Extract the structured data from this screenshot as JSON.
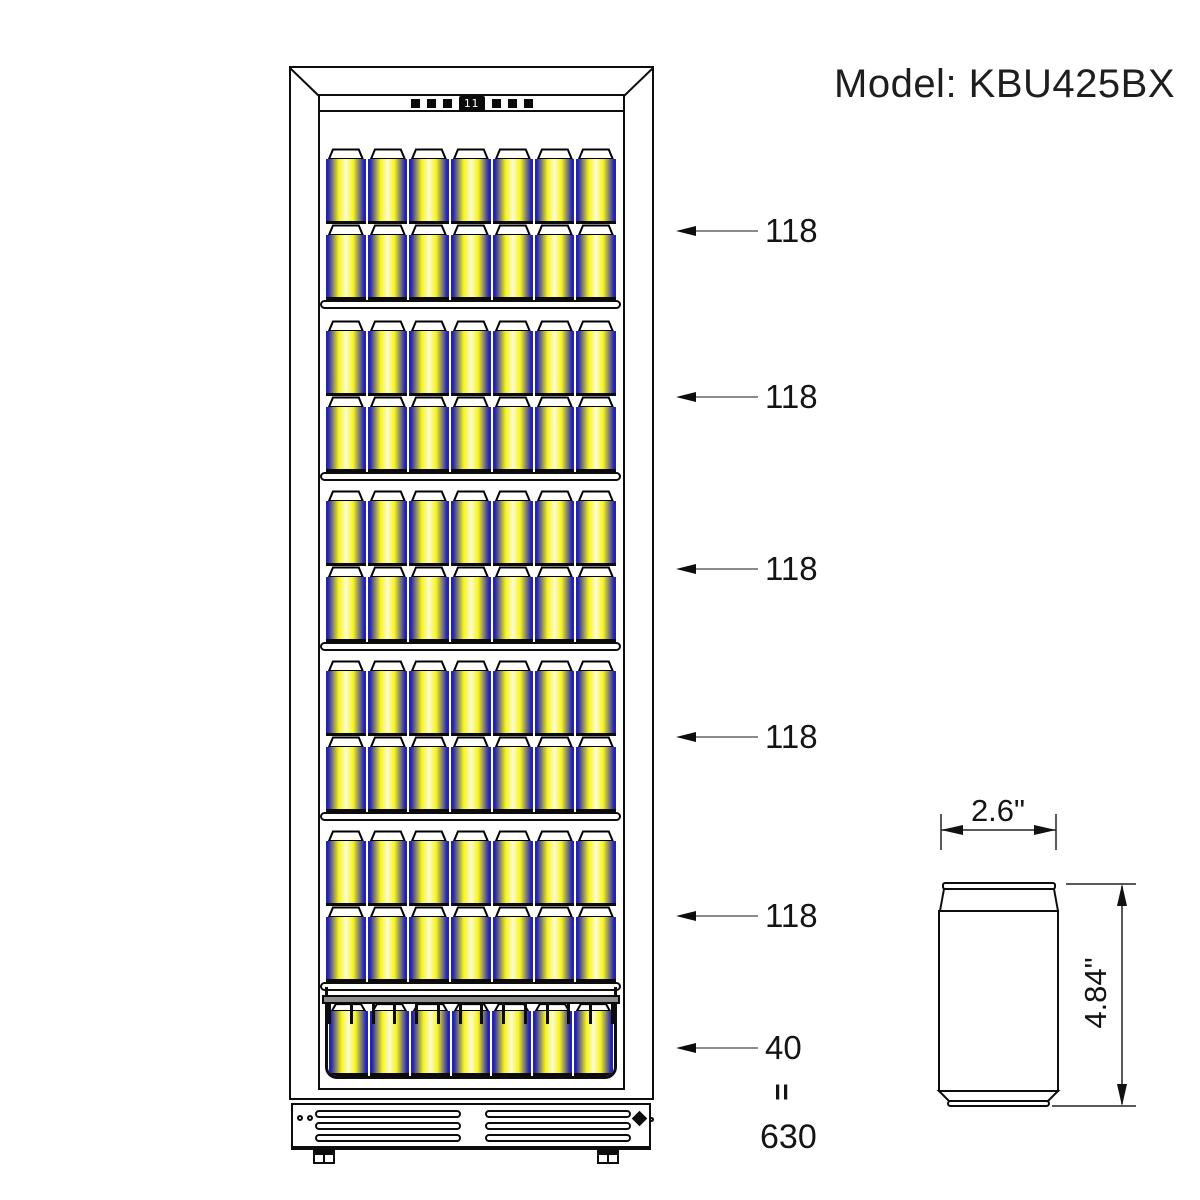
{
  "title": "Model: KBU425BX",
  "fridge": {
    "display_value": "11",
    "shelves": [
      {
        "label": "118",
        "rows": 2,
        "cans_per_row": 7,
        "type": "shelf"
      },
      {
        "label": "118",
        "rows": 2,
        "cans_per_row": 7,
        "type": "shelf"
      },
      {
        "label": "118",
        "rows": 2,
        "cans_per_row": 7,
        "type": "shelf"
      },
      {
        "label": "118",
        "rows": 2,
        "cans_per_row": 7,
        "type": "shelf"
      },
      {
        "label": "118",
        "rows": 2,
        "cans_per_row": 7,
        "type": "shelf"
      },
      {
        "label": "40",
        "rows": 1,
        "cans_per_row": 7,
        "type": "basket"
      }
    ],
    "total_equation": {
      "equals": "=",
      "total": "630"
    }
  },
  "can_diagram": {
    "width_label": "2.6\"",
    "height_label": "4.84\""
  },
  "colors": {
    "line_black": "#0d0d0d",
    "arrow_gray": "#8c8c8c",
    "can_blue": "#2222b4",
    "can_yellow": "#f7f41c",
    "can_highlight": "#fdfbd2",
    "rail_gray": "#8f8f8f"
  }
}
